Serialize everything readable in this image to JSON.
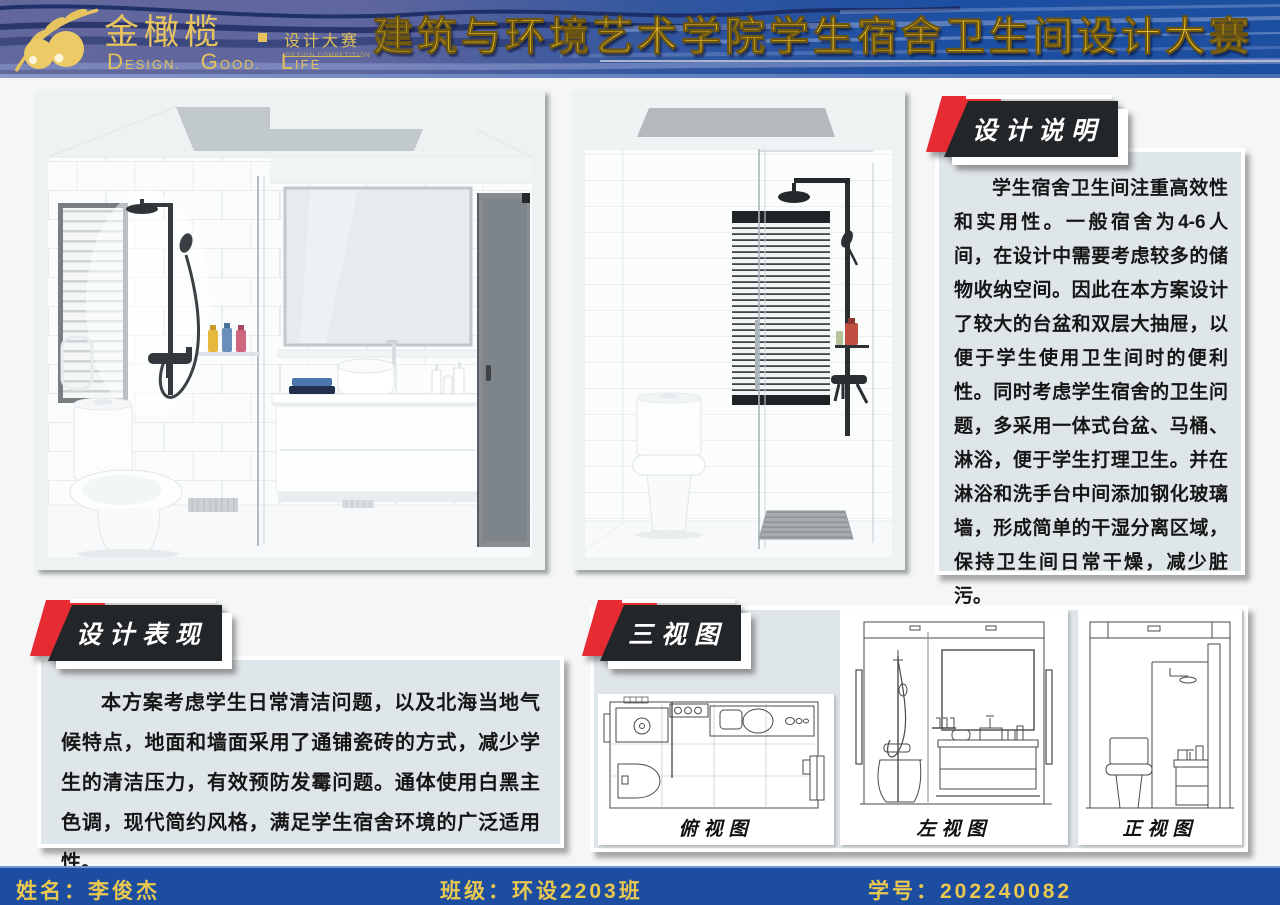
{
  "header": {
    "brand": "金橄榄",
    "brand_dot": "",
    "brand_sub": "设计大赛",
    "brand_sub_tiny": "DESIGN COMPETITION",
    "tagline_words": [
      "Design.",
      "Good.",
      "Life"
    ],
    "title": "建筑与环境艺术学院学生宿舍卫生间设计大赛"
  },
  "sections": {
    "design_notes": {
      "label": "设计说明",
      "body": "学生宿舍卫生间注重高效性和实用性。一般宿舍为4-6人间，在设计中需要考虑较多的储物收纳空间。因此在本方案设计了较大的台盆和双层大抽屉，以便于学生使用卫生间时的便利性。同时考虑学生宿舍的卫生问题，多采用一体式台盆、马桶、淋浴，便于学生打理卫生。并在淋浴和洗手台中间添加钢化玻璃墙，形成简单的干湿分离区域，保持卫生间日常干燥，减少脏污。"
    },
    "design_expression": {
      "label": "设计表现",
      "body": "本方案考虑学生日常清洁问题，以及北海当地气候特点，地面和墙面采用了通铺瓷砖的方式，减少学生的清洁压力，有效预防发霉问题。通体使用白黑主色调，现代简约风格，满足学生宿舍环境的广泛适用性。"
    },
    "three_views": {
      "label": "三视图",
      "views": [
        {
          "caption": "俯视图"
        },
        {
          "caption": "左视图"
        },
        {
          "caption": "正视图"
        }
      ]
    }
  },
  "footer": {
    "name": "姓名：李俊杰",
    "class": "班级：环设2203班",
    "student_id": "学号：202240082"
  },
  "colors": {
    "header_blue_left": "#62689c",
    "header_blue_right": "#1c4fa2",
    "gold": "#e6c35f",
    "title_gold": "#f3c82e",
    "label_black": "#232629",
    "label_red": "#e62b33",
    "panel_bg": "#dfe6e9",
    "footer_blue": "#1d4da1",
    "page_bg": "#f4f6f7"
  }
}
